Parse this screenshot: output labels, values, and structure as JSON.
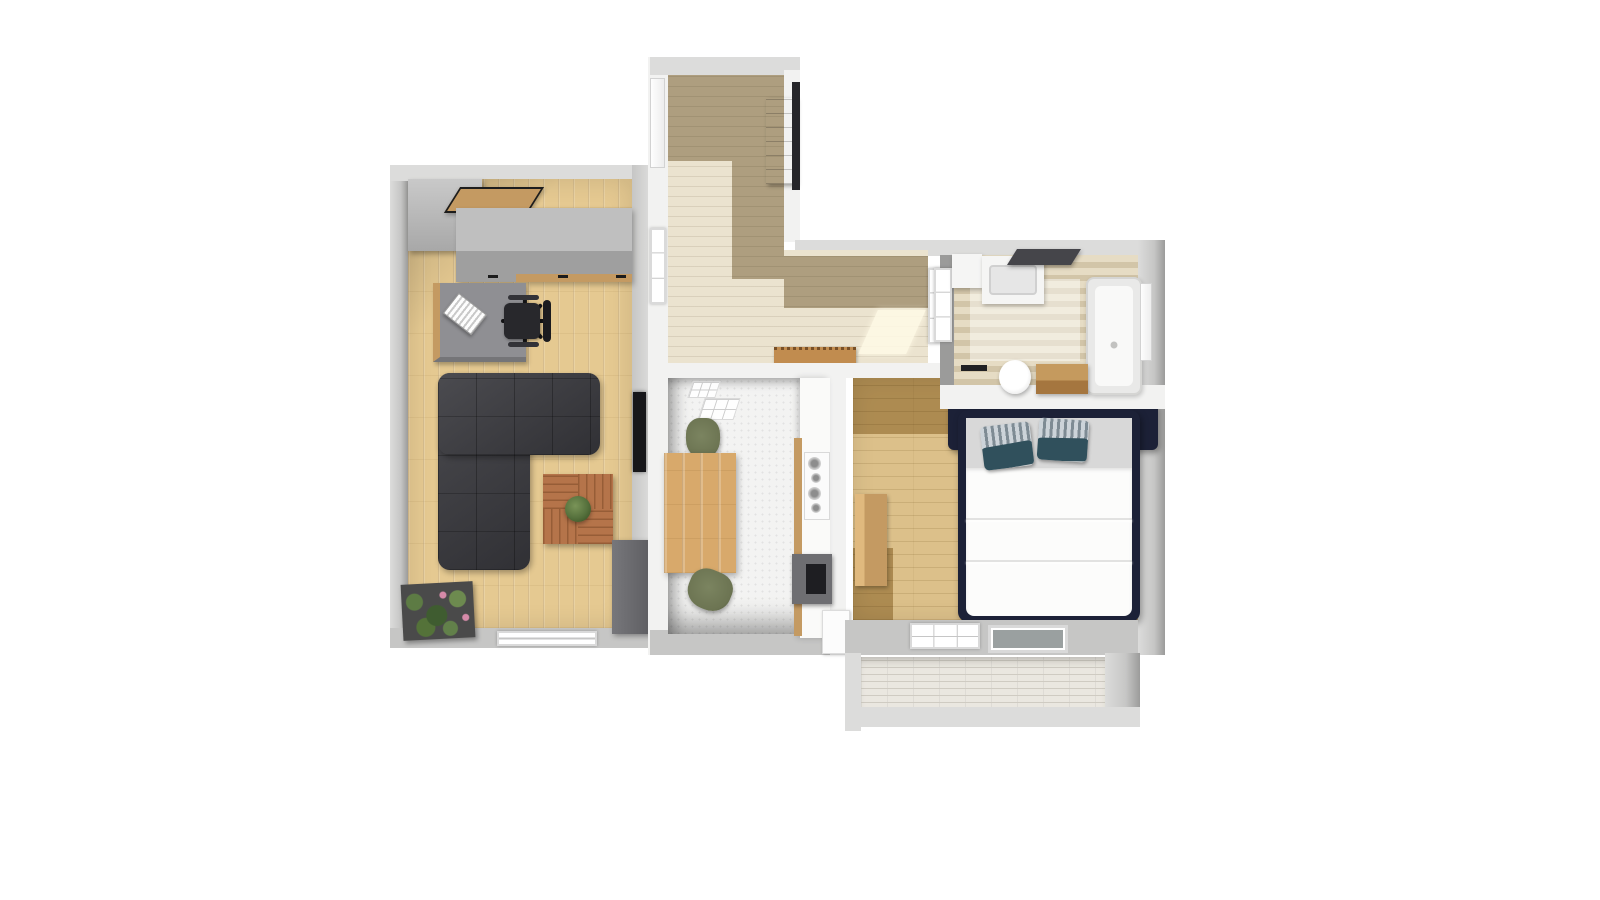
{
  "title": "apartment-3d-floor-plan",
  "palette": {
    "canvas_bg": "#ffffff",
    "wall_white": "#f2f2f1",
    "wall_light": "#dcdcdb",
    "wall_mid": "#c6c6c5",
    "wall_dark": "#9b9b9a",
    "oak": "#e5c991",
    "hall_light": "#ebe3cf",
    "hall_dark": "#b1a58c",
    "tile_white": "#f3f3f2",
    "bath_floor_a": "#e6dcc4",
    "bath_floor_b": "#d2c5a8",
    "bedroom_oak": "#dcc08a",
    "bedroom_oak_dark": "#b7a273",
    "sofa": "#37373c",
    "coffee_wood": "#b5744a",
    "dining_wood": "#d8a96b",
    "chair_green": "#6c7452",
    "bench_wood": "#c18c4f",
    "hall_cabinet": "#8a5a36",
    "bed_navy": "#1c2137",
    "pillow_teal": "#30505c",
    "sheet_gray": "#d8d8d8",
    "duvet_white": "#fcfcfb",
    "plant_green": "#55703c",
    "planter_dark": "#4a4a4a",
    "appliance_dark": "#6e6e72",
    "counter_white": "#fafaf9",
    "brick": "#eae7e0",
    "brick_line": "#cfcbc2",
    "glass_dark": "#9aa0a0",
    "desk_gray": "#8f8f93",
    "tv_black": "#17171a",
    "wood_counter": "#c49a62"
  },
  "rooms": [
    {
      "id": "living-room",
      "furniture": [
        "corner-wardrobe",
        "wall-shelf",
        "sideboard",
        "desk",
        "laptop",
        "office-chair",
        "corner-sofa",
        "coffee-table",
        "table-plant",
        "planter-box",
        "wall-tv",
        "lowboard",
        "window"
      ]
    },
    {
      "id": "hallway",
      "furniture": [
        "entrance-door",
        "tall-cabinet",
        "glazed-door",
        "bench",
        "window"
      ]
    },
    {
      "id": "kitchen",
      "furniture": [
        "dining-table",
        "chair",
        "chair",
        "counter",
        "cooktop",
        "sink-unit",
        "fridge",
        "skylights"
      ]
    },
    {
      "id": "bedroom",
      "furniture": [
        "double-bed",
        "pillows",
        "nightstand",
        "window",
        "balcony-glass-door"
      ]
    },
    {
      "id": "bathroom",
      "furniture": [
        "vanity-sink",
        "mirror",
        "side-cabinet",
        "bathtub",
        "toilet",
        "towel-bar",
        "wood-cabinet",
        "door",
        "interior-window"
      ]
    },
    {
      "id": "balcony",
      "furniture": [
        "brick-paved-floor"
      ]
    }
  ]
}
